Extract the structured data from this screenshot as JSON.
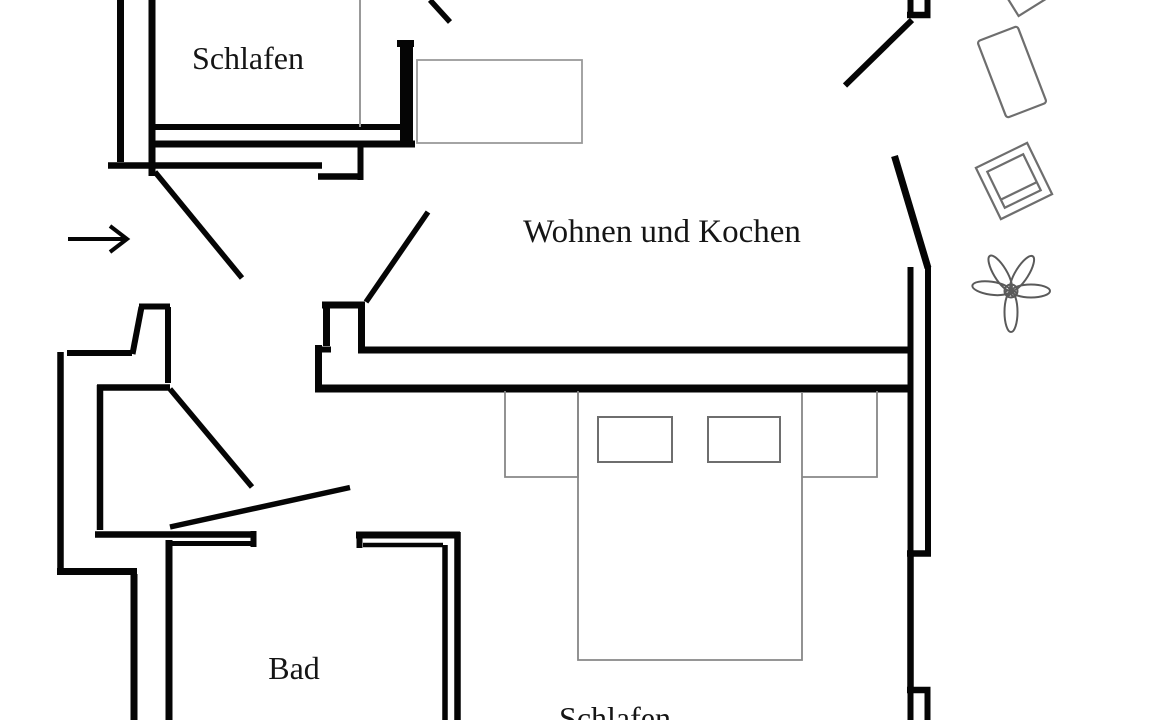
{
  "plan": {
    "rooms": [
      {
        "id": "schlafen-top",
        "label": "Schlafen"
      },
      {
        "id": "wohnen-und-kochen",
        "label": "Wohnen und Kochen"
      },
      {
        "id": "bad",
        "label": "Bad"
      },
      {
        "id": "schlafen-bottom",
        "label": "Schlafen"
      }
    ],
    "icons": {
      "entrance-arrow": "→",
      "plant": "✿",
      "balcony-table": "rotated rectangle outline",
      "balcony-chair": "rotated square with inner seat",
      "double-bed": "rectangle with two pillows and two nightstands",
      "single-bed": "rectangle outline"
    },
    "colors": {
      "wall": "#000000",
      "furniture_line": "#8a8a8a",
      "text": "#151515",
      "background": "#ffffff"
    }
  }
}
